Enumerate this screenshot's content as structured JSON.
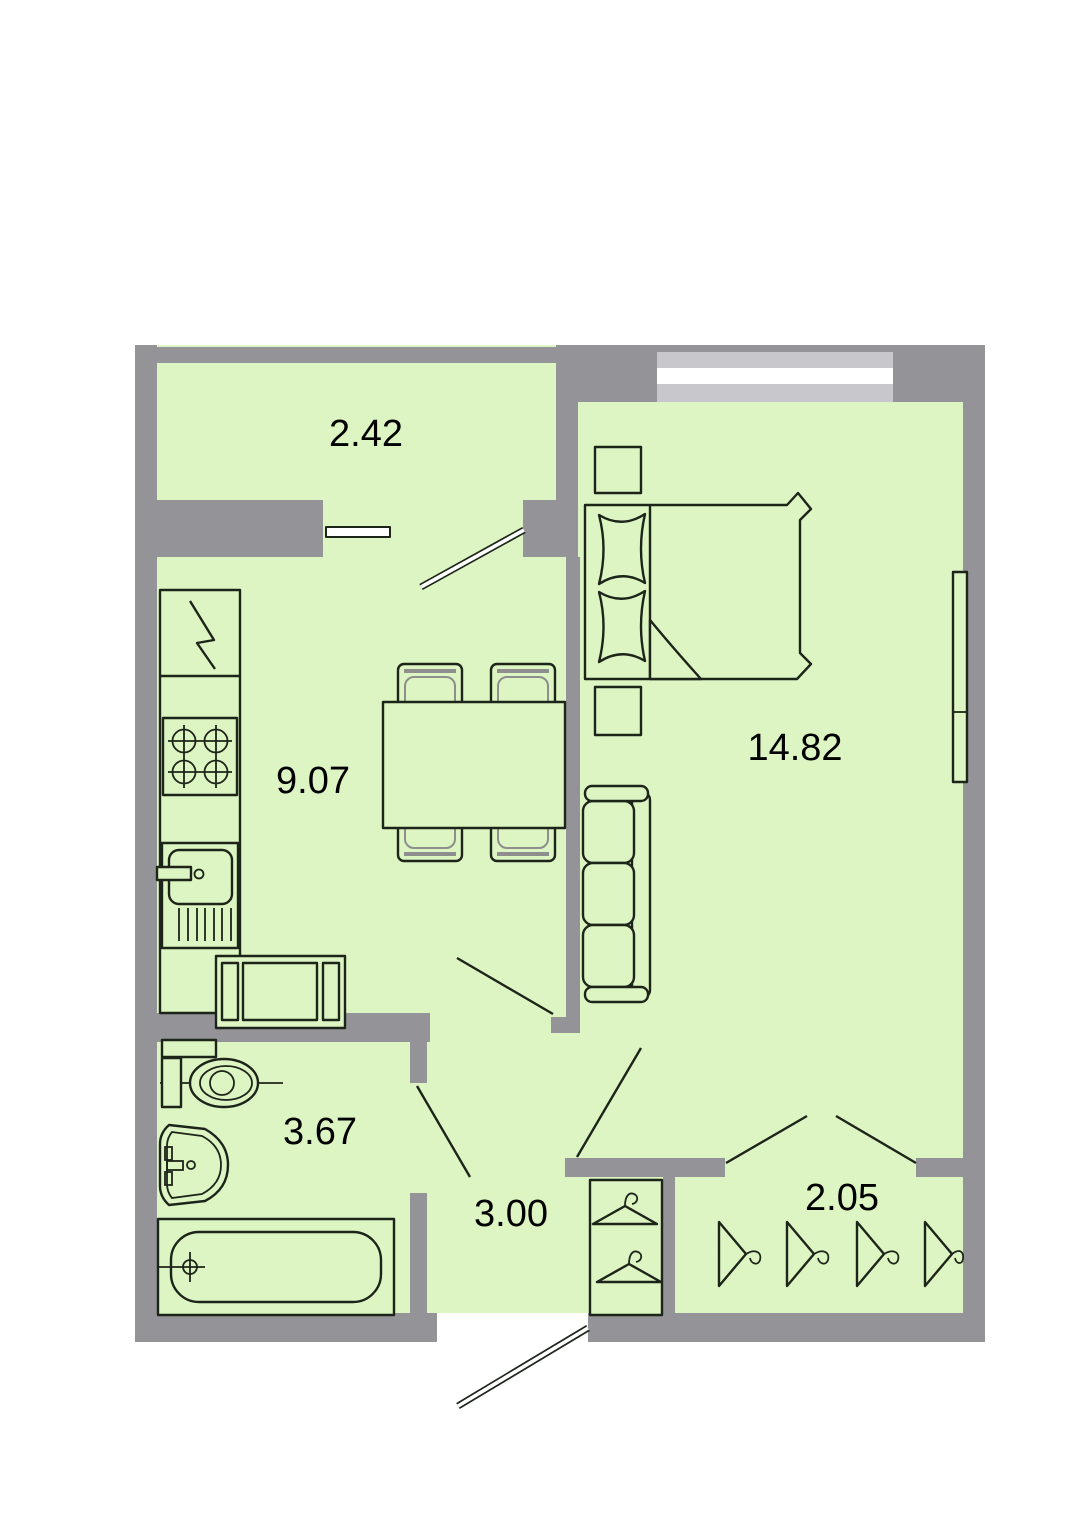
{
  "floor_plan": {
    "rooms": [
      {
        "name": "balcony",
        "area_label": "2.42"
      },
      {
        "name": "kitchen",
        "area_label": "9.07"
      },
      {
        "name": "bedroom",
        "area_label": "14.82"
      },
      {
        "name": "bathroom",
        "area_label": "3.67"
      },
      {
        "name": "hallway",
        "area_label": "3.00"
      },
      {
        "name": "wardrobe",
        "area_label": "2.05"
      }
    ],
    "furniture_symbols": [
      "fridge-icon",
      "stove-icon",
      "kitchen-sink-icon",
      "kitchen-bench-icon",
      "dining-table-icon",
      "chair-icon",
      "double-bed-icon",
      "pillow-icon",
      "nightstand-icon",
      "sofa-icon",
      "radiator-icon",
      "toilet-icon",
      "washbasin-icon",
      "bathtub-icon",
      "clothes-hanger-icon",
      "door-leaf-icon",
      "window-icon"
    ],
    "colors": {
      "room_fill": "#ddf5c2",
      "wall": "#949498",
      "window_band": "#c8c8cc",
      "glass_white": "#ffffff",
      "line": "#1d241a",
      "accent_gray": "#8e8e8e",
      "label_text": "#000000",
      "background": "#ffffff"
    }
  }
}
